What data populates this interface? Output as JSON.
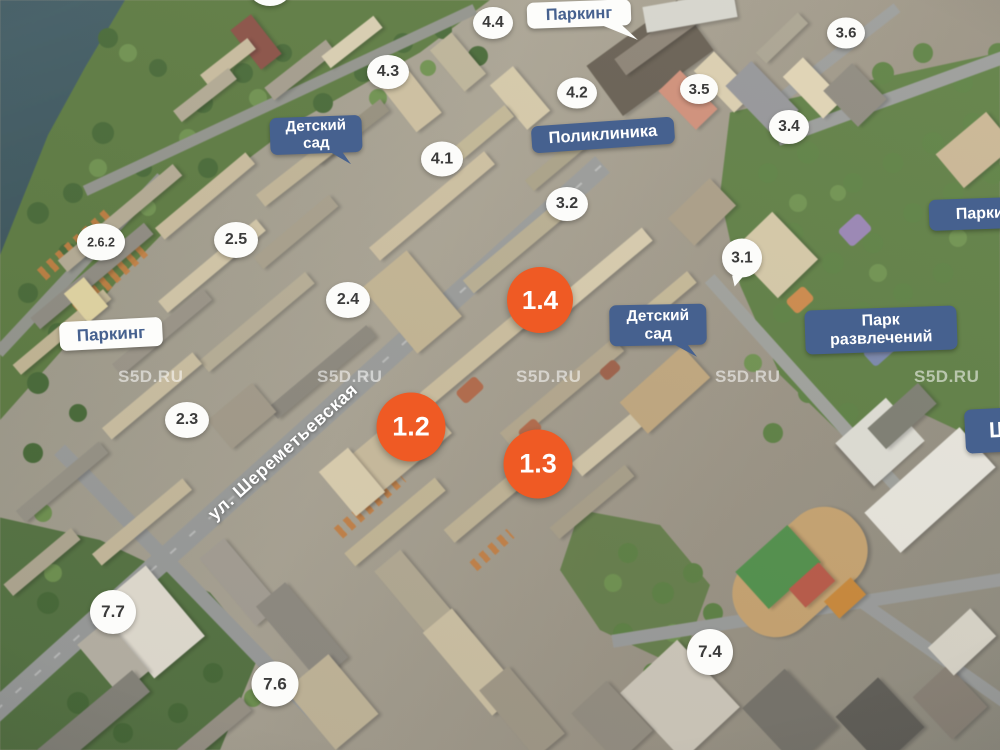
{
  "map": {
    "watermark": "S5D.RU",
    "street_name": "ул. Шереметьевская"
  },
  "markers": {
    "orange": [
      {
        "label": "1.2"
      },
      {
        "label": "1.3"
      },
      {
        "label": "1.4"
      }
    ],
    "white": [
      {
        "label": "2.3"
      },
      {
        "label": "2.4"
      },
      {
        "label": "2.5"
      },
      {
        "label": "2.6.2"
      },
      {
        "label": "3.1"
      },
      {
        "label": "3.2"
      },
      {
        "label": "3.4"
      },
      {
        "label": "3.5"
      },
      {
        "label": "3.6"
      },
      {
        "label": "4.1"
      },
      {
        "label": "4.2"
      },
      {
        "label": "4.3"
      },
      {
        "label": "4.4"
      },
      {
        "label": "7.4"
      },
      {
        "label": "7.6"
      },
      {
        "label": "7.7"
      }
    ]
  },
  "labels": {
    "parking_top": "Паркинг",
    "parking_west": "Паркинг",
    "parking_east": "Паркинг",
    "polyclinic": "Поликлиника",
    "kindergarten_north": {
      "line1": "Детский",
      "line2": "сад"
    },
    "kindergarten_center": {
      "line1": "Детский",
      "line2": "сад"
    },
    "amusement_park": {
      "line1": "Парк",
      "line2": "развлечений"
    },
    "school_partial": "Ш"
  },
  "colors": {
    "marker_orange": "#ef5a24",
    "label_blue": "#46618f",
    "marker_white_bg": "#fcfcfa",
    "water": "#35505a",
    "forest": "#5d7c42"
  }
}
